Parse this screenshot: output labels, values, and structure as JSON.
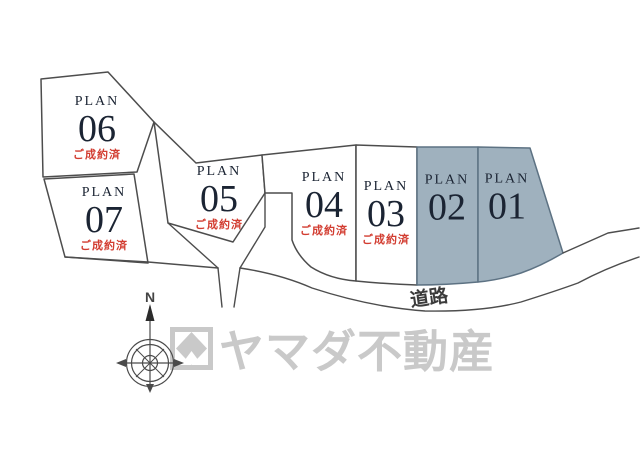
{
  "plots": [
    {
      "plan_label": "PLAN",
      "number": "06",
      "status": "ご成約済",
      "shaded": false
    },
    {
      "plan_label": "PLAN",
      "number": "07",
      "status": "ご成約済",
      "shaded": false
    },
    {
      "plan_label": "PLAN",
      "number": "05",
      "status": "ご成約済",
      "shaded": false
    },
    {
      "plan_label": "PLAN",
      "number": "04",
      "status": "ご成約済",
      "shaded": false
    },
    {
      "plan_label": "PLAN",
      "number": "03",
      "status": "ご成約済",
      "shaded": false
    },
    {
      "plan_label": "PLAN",
      "number": "02",
      "status": "",
      "shaded": true
    },
    {
      "plan_label": "PLAN",
      "number": "01",
      "status": "",
      "shaded": true
    }
  ],
  "road": {
    "label": "道路"
  },
  "compass": {
    "north_label": "N"
  },
  "watermark": {
    "text": "ヤマダ不動産"
  },
  "colors": {
    "shaded_fill": "#9fb1be",
    "shaded_stroke": "#5d7283",
    "line": "#4d4d4d",
    "sold_red": "#d23c30",
    "number_dark": "#1b2433",
    "road_text": "#3c3c3c",
    "watermark_gray": "#c9c9c9"
  }
}
